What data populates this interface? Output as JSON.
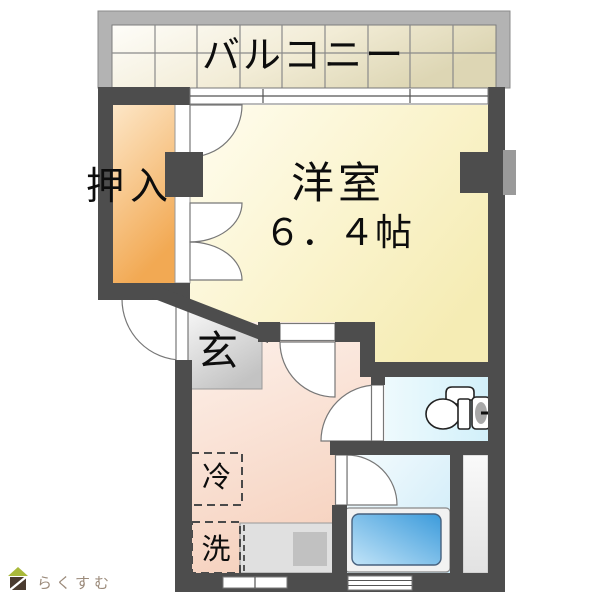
{
  "floor_plan": {
    "balcony": {
      "label": "バルコニー"
    },
    "closet": {
      "label": "押入"
    },
    "western_room": {
      "label": "洋室",
      "size_label": "６．４帖"
    },
    "entrance": {
      "label": "玄"
    },
    "kitchen": {
      "refrigerator_label": "冷",
      "washer_label": "洗"
    },
    "fixtures": {
      "toilet": "toilet-bowl-icon",
      "bathtub": "bathtub-icon",
      "kitchen_counter": "counter-with-sink",
      "windows": "sliding-window-symbols",
      "doors": "swing-door-arc-symbols"
    },
    "colors": {
      "wall": "#4d4d4d",
      "balcony_frame": "#b3b3b3",
      "balcony_tile": "#ece6cc",
      "closet_fill": "#f5b261",
      "western_room_fill": "#f9f1c4",
      "entrance_fill": "#d6d6d6",
      "kitchen_fill": "#f9dccd",
      "toilet_fill": "#e2f5fb",
      "bath_fill": "#d9eefa",
      "bathtub_fill": "#4aa0dd",
      "counter_fill": "#e0e0e0",
      "logo_green": "#a9b93a",
      "logo_brown": "#4a3b2f"
    }
  },
  "watermark": {
    "brand": "らくすむ"
  }
}
